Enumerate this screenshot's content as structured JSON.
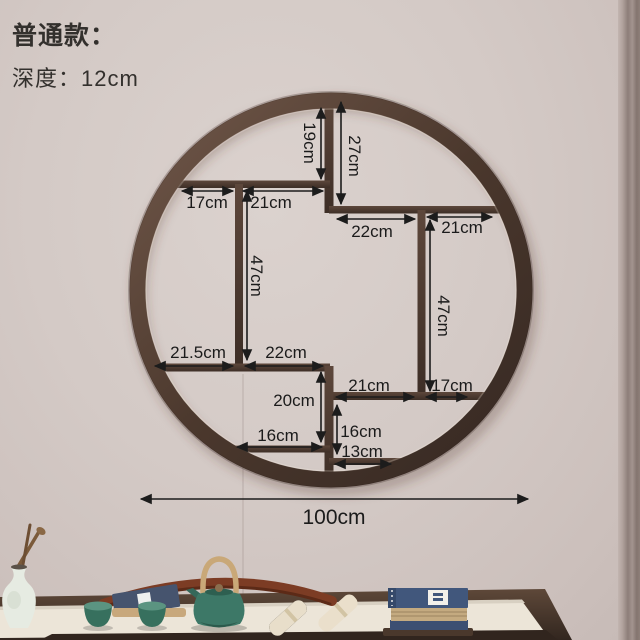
{
  "header": {
    "variant_label": "普通款：",
    "depth_label": "深度：12cm"
  },
  "diagram": {
    "unit": "cm",
    "dims": {
      "d19": "19cm",
      "d27": "27cm",
      "d17a": "17cm",
      "d21a": "21cm",
      "d22a": "22cm",
      "d21b": "21cm",
      "d47a": "47cm",
      "d47b": "47cm",
      "d215": "21.5cm",
      "d22b": "22cm",
      "d21c": "21cm",
      "d17b": "17cm",
      "d20": "20cm",
      "d16a": "16cm",
      "d16b": "16cm",
      "d13": "13cm",
      "d100": "100cm"
    },
    "colors": {
      "frame_wood": "#4a372c",
      "annotation": "#1c1c1c",
      "wall": "#d3c9c5",
      "teal_ceramic": "#3d7867",
      "table_wood": "#43322a"
    }
  }
}
